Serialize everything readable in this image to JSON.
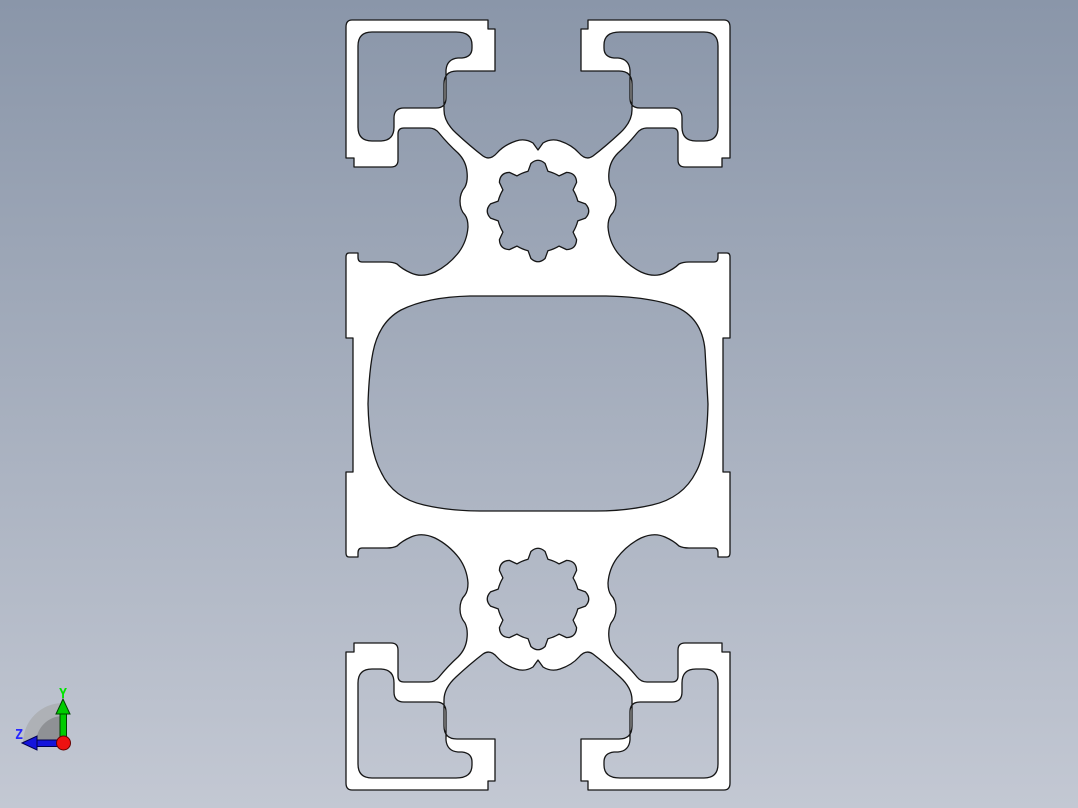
{
  "viewer": {
    "type": "cad-viewport",
    "background_top": "#8a96a9",
    "background_bottom": "#c3c8d3"
  },
  "part": {
    "label": "aluminum-extrusion-profile-cross-section",
    "fill": "#ffffff",
    "outline": "#161616"
  },
  "axis_triad": {
    "y_label": "Y",
    "z_label": "Z",
    "y_color": "#00cc00",
    "y_dark": "#004400",
    "y_label_color": "#00e400",
    "z_color": "#1414dc",
    "z_dark": "#000050",
    "z_label_color": "#2828ff",
    "origin_color": "#ee1111",
    "origin_dark": "#660000",
    "fan_color": "#aeb1b6",
    "fan_inner_color": "#8f9195"
  }
}
